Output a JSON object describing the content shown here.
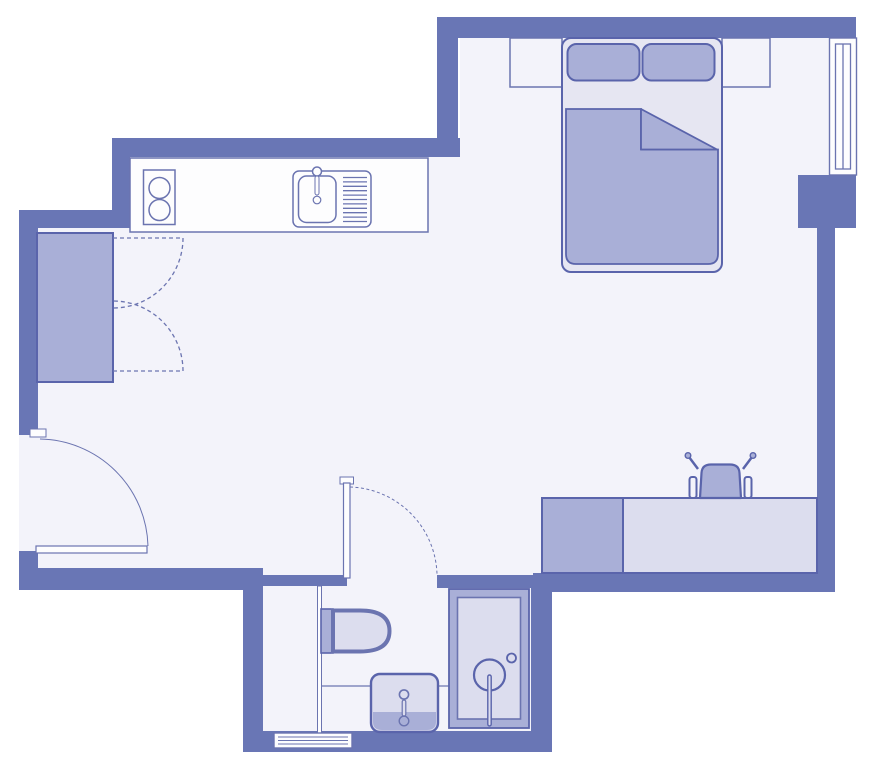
{
  "title": "Studio apartment floor plan",
  "colors": {
    "outside": "#ffffff",
    "wall": "#6976b5",
    "floor": "#f3f3fa",
    "furniture_medium": "#a9afd7",
    "furniture_light": "#dcddee",
    "bed_sheet": "#e6e6f2",
    "outline_dark": "#5a64ab",
    "outline_thin": "#6b74b0",
    "fixture_white": "#fdfdfe"
  },
  "elements": {
    "walls": "exterior and interior walls",
    "furniture": [
      {
        "name": "kitchen-counter"
      },
      {
        "name": "stove-two-burners"
      },
      {
        "name": "kitchen-sink-with-drainboard"
      },
      {
        "name": "wardrobe"
      },
      {
        "name": "closet-double-doors"
      },
      {
        "name": "entry-door"
      },
      {
        "name": "double-bed-with-pillows-and-duvet"
      },
      {
        "name": "nightstand-left"
      },
      {
        "name": "nightstand-right"
      },
      {
        "name": "window"
      },
      {
        "name": "desk"
      },
      {
        "name": "cabinet"
      },
      {
        "name": "desk-chair"
      },
      {
        "name": "bathroom-door"
      },
      {
        "name": "toilet"
      },
      {
        "name": "washbasin"
      },
      {
        "name": "shower"
      },
      {
        "name": "vent-grille"
      }
    ]
  }
}
